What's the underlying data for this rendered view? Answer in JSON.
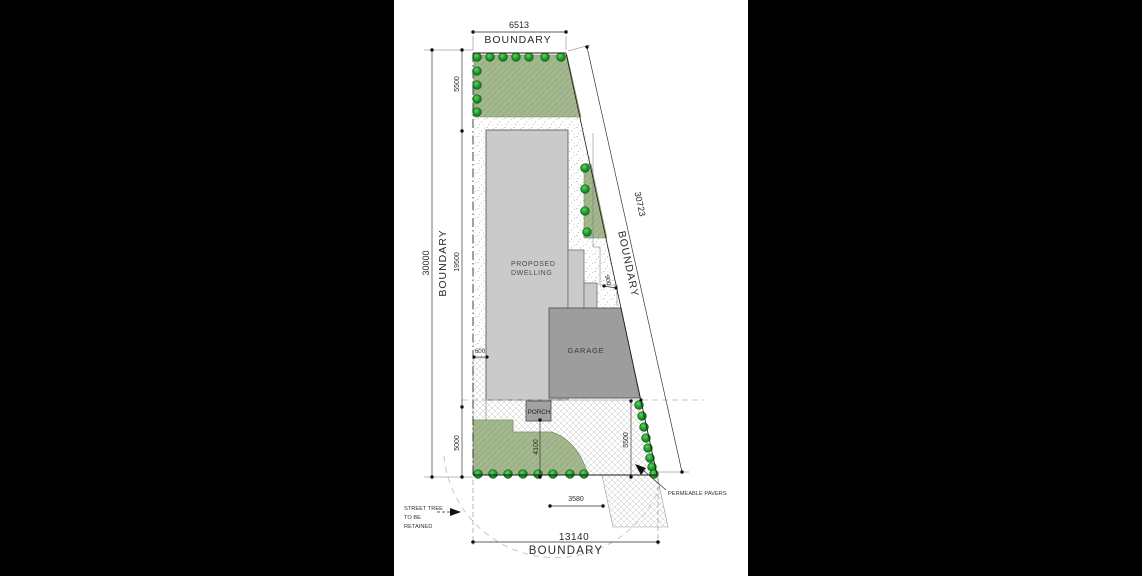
{
  "document": {
    "type": "architectural-site-plan"
  },
  "boundaries": {
    "top": {
      "value": "6513",
      "label": "BOUNDARY"
    },
    "left": {
      "value": "30000",
      "label": "BOUNDARY"
    },
    "right": {
      "value": "30723",
      "label": "BOUNDARY"
    },
    "front": {
      "value": "13140",
      "label": "BOUNDARY"
    }
  },
  "setbacks": {
    "rear_landscape_depth": "5500",
    "dwelling_length": "19500",
    "front_setback": "5000",
    "side_setback": "600",
    "step_setback": "900",
    "porch_to_front_boundary": "4100",
    "garage_side_depth": "5500",
    "crossover_width": "3580"
  },
  "building_labels": {
    "dwelling_line1": "PROPOSED",
    "dwelling_line2": "DWELLING",
    "garage": "GARAGE",
    "porch": "PORCH"
  },
  "annotations": {
    "pavers": "PERMEABLE PAVERS",
    "street_tree_line1": "STREET TREE",
    "street_tree_line2": "TO BE",
    "street_tree_line3": "RETAINED"
  },
  "colors": {
    "landscape_green": "#a4b890",
    "landscape_hatch": "#93a87c",
    "tree_green": "#1f9c2a",
    "dwelling_gray": "#cacaca",
    "garage_gray": "#9d9d9d",
    "porch_gray": "#a2a2a2",
    "line_black": "#1c1c1c",
    "letterbox": "#000000"
  }
}
